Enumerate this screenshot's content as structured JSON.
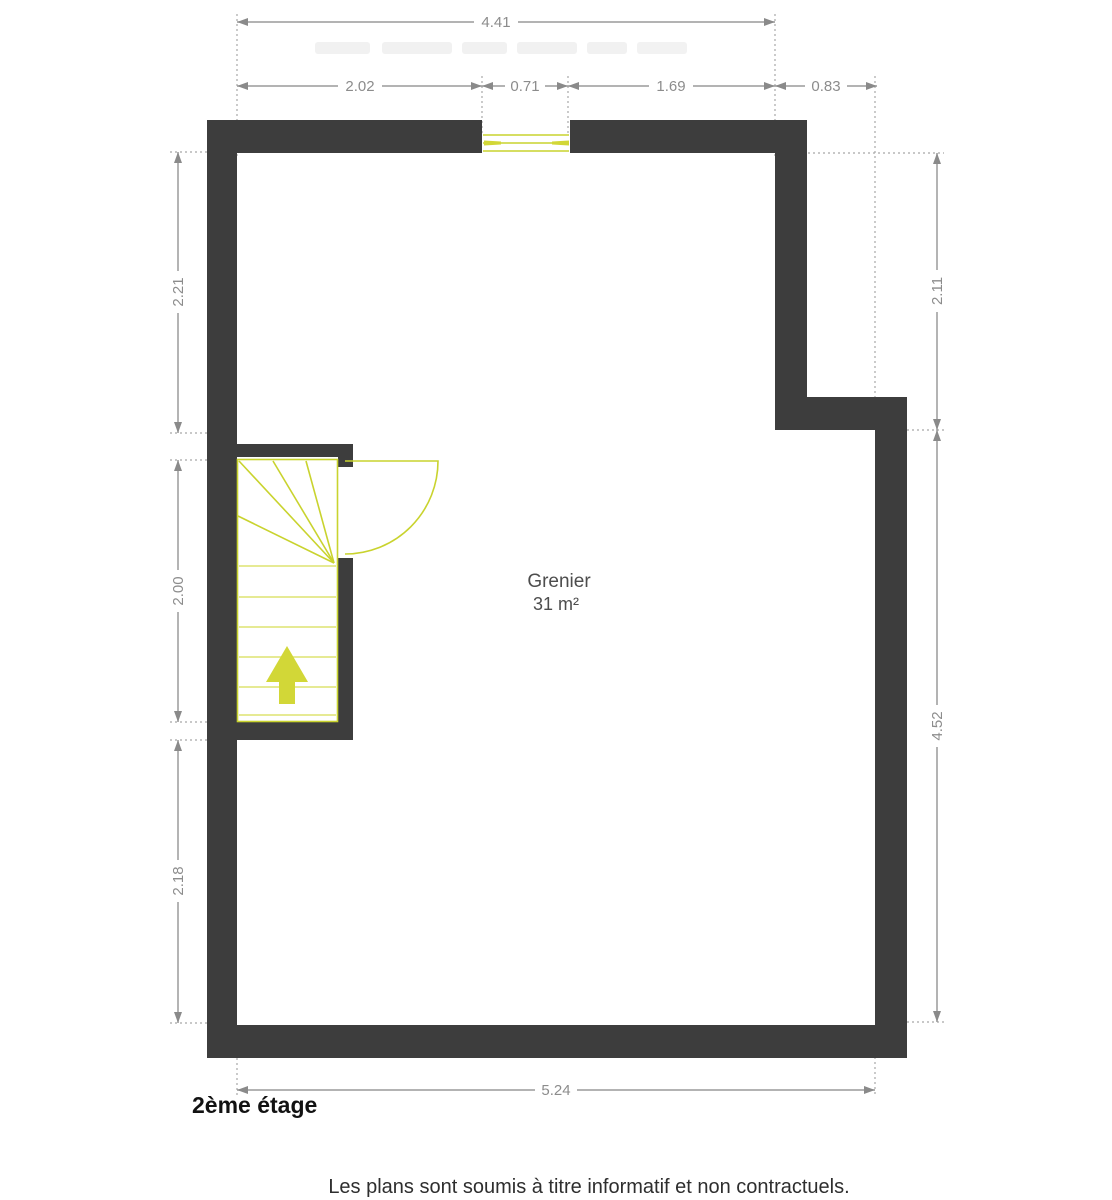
{
  "plan": {
    "room": {
      "name": "Grenier",
      "area": "31 m²"
    },
    "floor_label": "2ème étage",
    "disclaimer": "Les plans sont soumis à titre informatif et non contractuels.",
    "dims": {
      "top_total": "4.41",
      "top_seg1": "2.02",
      "top_seg2": "0.71",
      "top_seg3": "1.69",
      "top_seg4": "0.83",
      "left_upper": "2.21",
      "left_mid": "2.00",
      "left_lower": "2.18",
      "right_upper": "2.11",
      "right_lower": "4.52",
      "bottom_total": "5.24"
    },
    "colors": {
      "wall": "#3d3d3d",
      "dim_line": "#9a9a9a",
      "arrow_head": "#8a8a8a",
      "ext_line": "#a8a8a8",
      "dim_text": "#8c8c8c",
      "stair_line": "#c9d32e",
      "tread_line": "#dde470",
      "arrow_fill": "#d2d737",
      "room_text": "#4d4d4d",
      "floor_text": "#121212",
      "disclaimer_text": "#2e2e2e"
    }
  }
}
